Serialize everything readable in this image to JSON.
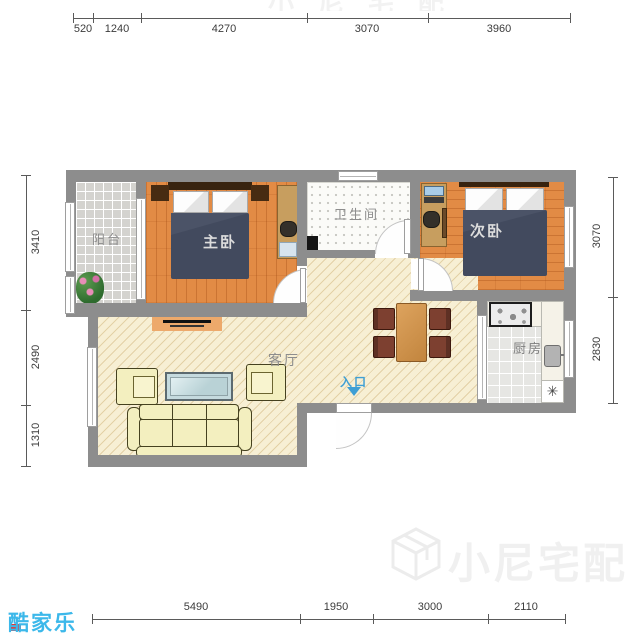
{
  "brand": {
    "logo_text": "酷家乐"
  },
  "watermark": {
    "text": "小尼宅配"
  },
  "rooms": {
    "balcony": {
      "label": "阳台"
    },
    "master_bedroom": {
      "label": "主卧"
    },
    "bathroom": {
      "label": "卫生间"
    },
    "second_bedroom": {
      "label": "次卧"
    },
    "living_room": {
      "label": "客厅"
    },
    "kitchen": {
      "label": "厨房"
    }
  },
  "entrance": {
    "label": "入口"
  },
  "kitchen_fixtures": {
    "star_symbol": "✳"
  },
  "dims": {
    "top": [
      "520",
      "1240",
      "4270",
      "3070",
      "3960"
    ],
    "bottom": [
      "5490",
      "1950",
      "3000",
      "2110"
    ],
    "left": [
      "3410",
      "2490",
      "1310"
    ],
    "right": [
      "3070",
      "2830"
    ]
  },
  "colors": {
    "wall": "#8d8d8d",
    "wood_floor": "#e28b45",
    "living_floor": "#f7efd4",
    "blanket": "#424a5e",
    "sofa": "#f3efbf",
    "entrance_blue": "#3f9fd4",
    "logo_blue": "#3cb8ea",
    "watermark_gray": "#f0f0f0"
  }
}
